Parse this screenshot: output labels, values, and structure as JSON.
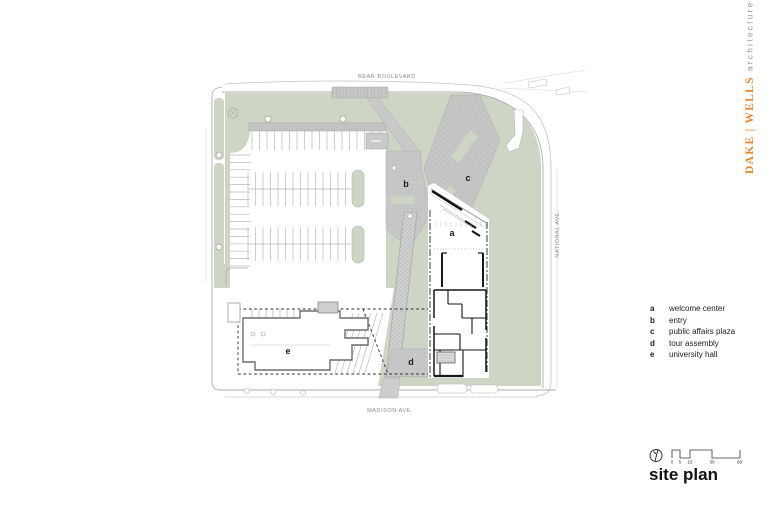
{
  "brand": {
    "name": "DAKE | WELLS",
    "suffix": "architecture"
  },
  "streets": {
    "top": "BEAR BOULEVARD",
    "right": "NATIONAL AVE.",
    "bottom": "MADISON AVE."
  },
  "plan_markers": {
    "a": "a",
    "b": "b",
    "c": "c",
    "d": "d",
    "e": "e"
  },
  "legend": {
    "items": [
      {
        "key": "a",
        "label": "welcome center"
      },
      {
        "key": "b",
        "label": "entry"
      },
      {
        "key": "c",
        "label": "public affairs plaza"
      },
      {
        "key": "d",
        "label": "tour assembly"
      },
      {
        "key": "e",
        "label": "university hall"
      }
    ]
  },
  "scale_bar": {
    "ticks": [
      "0",
      "5",
      "15",
      "30",
      "60'"
    ]
  },
  "title": "site plan",
  "colors": {
    "accent_orange": "#e8872b",
    "landscape_green": "#cdd6c5",
    "pavement_gray": "#c8c8c8",
    "line_gray": "#adadad"
  }
}
